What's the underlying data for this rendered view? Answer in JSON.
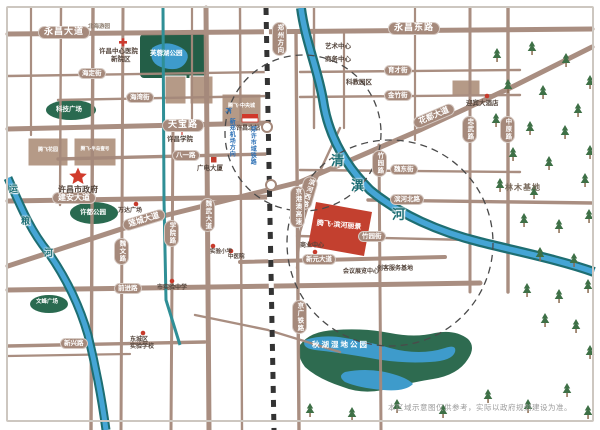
{
  "map": {
    "colors": {
      "road": "#a5897b",
      "river_edge": "#1e6e72",
      "river_core": "#45a5d5",
      "park": "#2a6a50",
      "project_red": "#c3402f",
      "railway": "#333333",
      "transit_blue": "#2b6fb5"
    },
    "roads": {
      "yongchang": "永昌大道",
      "yongchang_east": "永昌东路",
      "haiding": "海定街",
      "haiwan": "海湾街",
      "yucai": "育才街",
      "jinzhu": "金竹街",
      "tianbao": "天宝路",
      "bayi": "八一路",
      "weidong": "魏东街",
      "jianan": "建安大道",
      "liancheng": "莲城大道",
      "huadu": "花都大道",
      "xueyuan": "学院路",
      "weiwen": "魏文路",
      "weiwu": "魏武大道",
      "qianjin": "前进路",
      "xinxing": "新兴路",
      "zhongwu": "忠武路",
      "zhongyuan": "中原路",
      "zhuyuan_road": "竹园路",
      "binhe_west": "滨河西路",
      "binhe_north": "滨河北路",
      "zhuyuan_street": "竹园街",
      "xinyuan": "新元大道",
      "jinggangao": "京港澳高速",
      "jingguang_railway": "京广铁路",
      "zhengzhou_direction": "郑州方向"
    },
    "rivers": {
      "east_1": "清",
      "east_2": "潩",
      "east_3": "河",
      "west_1": "运",
      "west_2": "粮",
      "west_3": "河"
    },
    "parks": {
      "furong": "芙蓉湖公园",
      "keji": "科技广场",
      "xudu": "许都公园",
      "wenfeng": "文峰广场",
      "qiuhu": "秋湖湿地公园",
      "linmu": "林木基地"
    },
    "pois": {
      "hospital_line1": "许昌中心医院",
      "hospital_line2": "新院区",
      "beihai": "北海游园",
      "art_center": "艺术中心",
      "biz_center": "商务中心",
      "kejiao": "科教园区",
      "hotel": "迎宾大酒店",
      "tengfei_garden": "腾飞花园",
      "tengfei_bandao": "腾飞·半岛壹号",
      "tengfei_zhongyang": "腾飞·中央城",
      "xuchang_college": "许昌学院",
      "city_gov": "许昌市政府",
      "wanda": "万达广场",
      "guangdian": "广电大厦",
      "north_station": "许昌北站",
      "airport": "新郑机场方向",
      "metro": "郑许市域铁路",
      "shangye": "商业中心",
      "exhibition": "会议展览中心",
      "chuangke": "创客服务基地",
      "shiyan_middle": "市实验中学",
      "dongcheng_line1": "东城区",
      "dongcheng_line2": "实验学校",
      "shiyan_primary": "实验小学",
      "tcm_hospital": "中医院"
    },
    "project": {
      "name": "腾飞·滨河丽景"
    },
    "footer": {
      "disclaimer": "本区域示意图仅供参考，实际以政府规划建设为准。"
    }
  }
}
